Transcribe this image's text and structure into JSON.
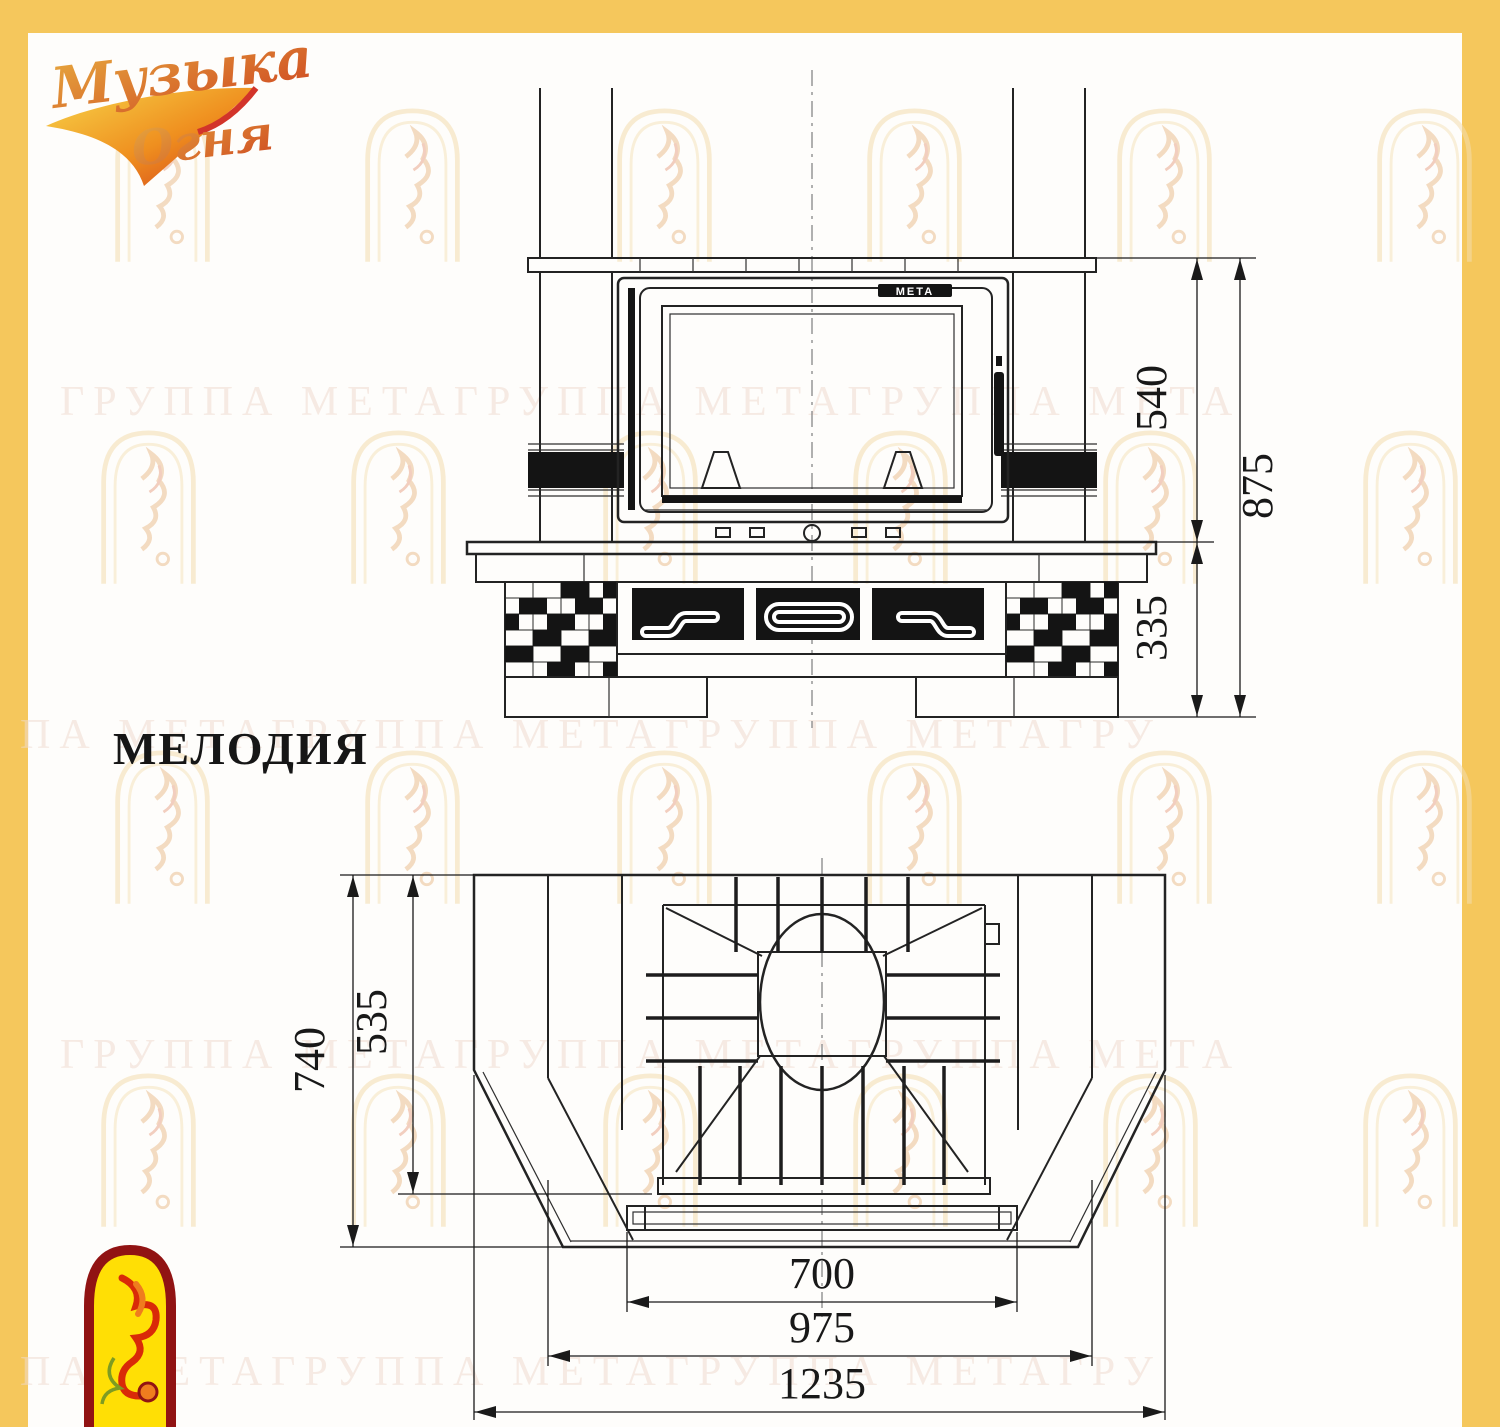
{
  "frame": {
    "color": "#f5c75c"
  },
  "logo": {
    "line1": "Музыка",
    "line2": "Огня"
  },
  "watermark": {
    "rows": [
      "ГРУППА МЕТАГРУППА МЕТАГРУППА МЕТА",
      "ПА МЕТАГРУППА МЕТАГРУППА МЕТАГРУ",
      "ГРУППА МЕТАГРУППА МЕТАГРУППА МЕТА",
      "ПА МЕТАГРУППА МЕТАГРУППА МЕТАГРУ"
    ]
  },
  "model": {
    "title": "МЕЛОДИЯ"
  },
  "front_view": {
    "firebox_brand": "МЕТА",
    "dimensions": {
      "door_height": "540",
      "total_height": "875",
      "plinth_height": "335"
    }
  },
  "top_view": {
    "dimensions": {
      "depth_total": "740",
      "depth_inner": "535",
      "width_opening": "700",
      "width_front": "975",
      "width_total": "1235"
    }
  }
}
